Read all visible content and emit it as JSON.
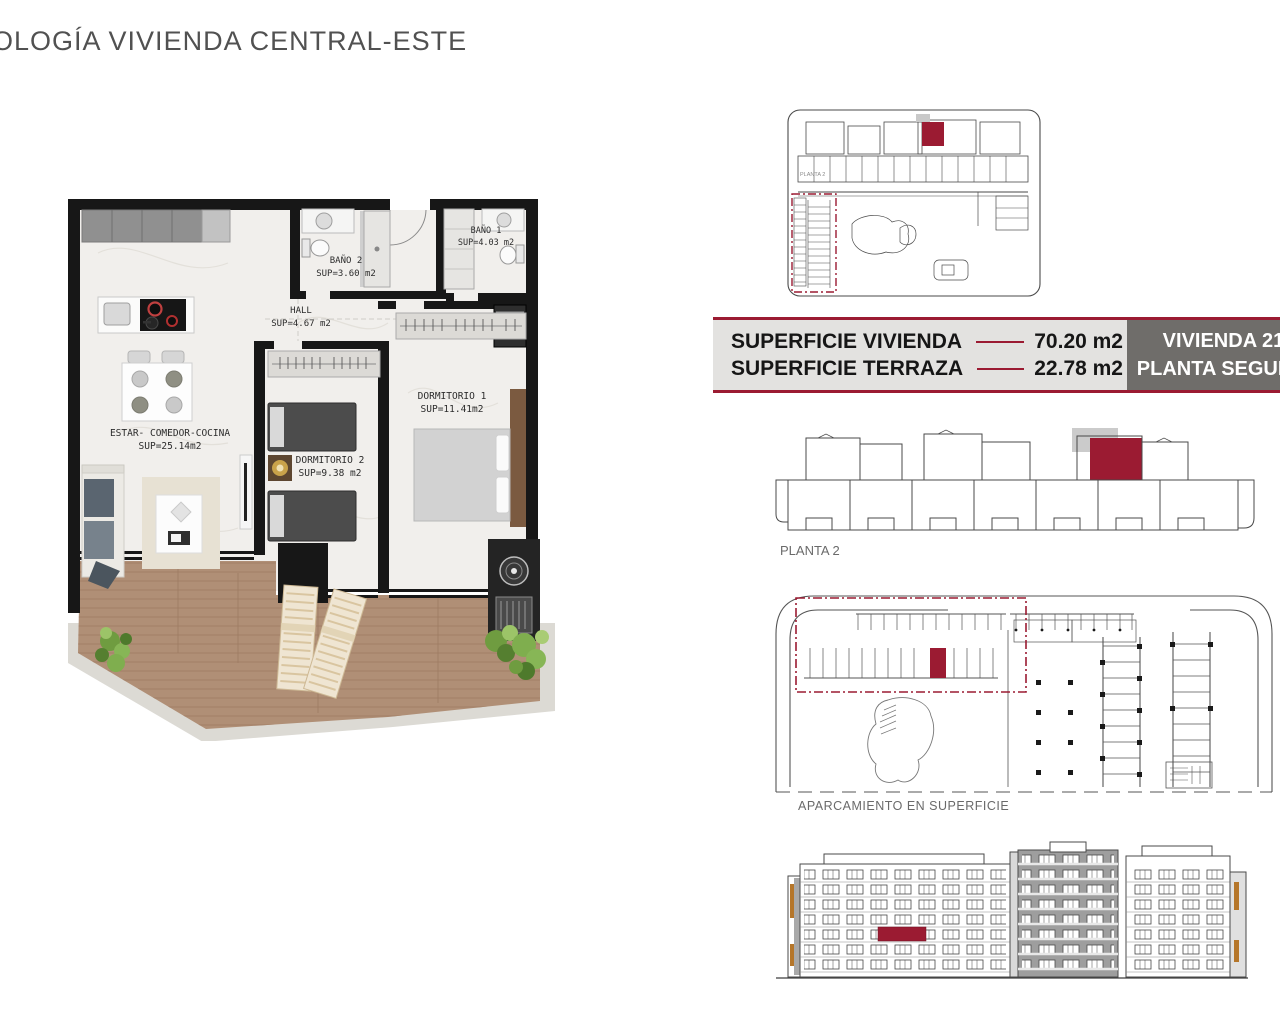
{
  "title": "OLOGÍA VIVIENDA CENTRAL-ESTE",
  "floor_plan": {
    "rooms": [
      {
        "name": "ESTAR- COMEDOR-COCINA",
        "sup": "SUP=25.14m2"
      },
      {
        "name": "BAÑO 2",
        "sup": "SUP=3.60 m2"
      },
      {
        "name": "HALL",
        "sup": "SUP=4.67 m2"
      },
      {
        "name": "BAÑO 1",
        "sup": "SUP=4.03 m2"
      },
      {
        "name": "DORMITORIO 2",
        "sup": "SUP=9.38 m2"
      },
      {
        "name": "DORMITORIO 1",
        "sup": "SUP=11.41m2"
      }
    ]
  },
  "site_plan": {
    "label": "PLANTA 2"
  },
  "info_bar": {
    "rows": [
      {
        "label": "SUPERFICIE VIVIENDA",
        "value": "70.20 m2"
      },
      {
        "label": "SUPERFICIE TERRAZA",
        "value": "22.78 m2"
      }
    ],
    "unit_box": {
      "line1": "VIVIENDA 212",
      "line2": "PLANTA SEGUNDA"
    }
  },
  "planta2": {
    "label": "PLANTA 2"
  },
  "parking": {
    "label": "APARCAMIENTO EN SUPERFICIE"
  },
  "colors": {
    "accent": "#9b1b32",
    "bar_background": "#e3e2e0",
    "unit_box_background": "#6f6d6a",
    "wood": "#b08f76",
    "plan_wall": "#171717",
    "highlight_gray": "#c9c9c9",
    "line_work": "#4a4a4a",
    "title_gray": "#515151"
  }
}
